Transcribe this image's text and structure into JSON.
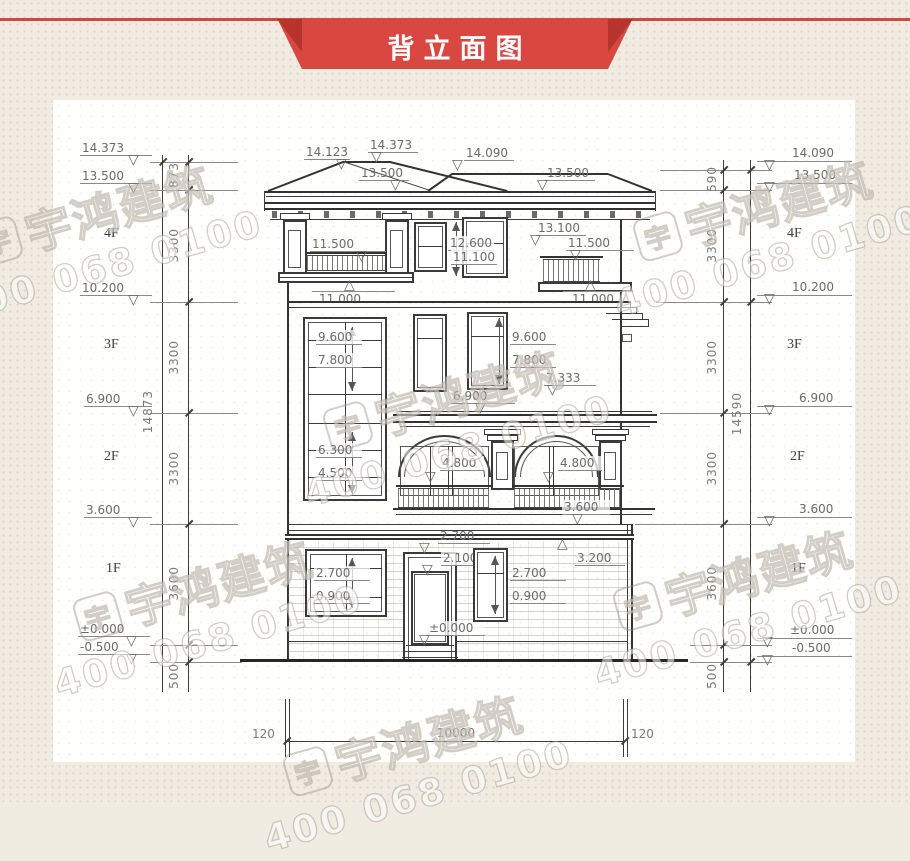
{
  "banner": {
    "title": "背立面图"
  },
  "watermark": {
    "brand": "宇鸿建筑",
    "phone": "400 068 0100",
    "logo_char": "宇"
  },
  "floors": {
    "f4": "4F",
    "f3": "3F",
    "f2": "2F",
    "f1": "1F"
  },
  "levels_left": {
    "l1": "14.373",
    "l2": "13.500",
    "l3": "10.200",
    "l4": "6.900",
    "l5": "3.600",
    "l6": "±0.000",
    "l7": "-0.500"
  },
  "levels_right": {
    "l1": "14.090",
    "l2": "13.500",
    "l3": "10.200",
    "l4": "6.900",
    "l5": "3.600",
    "l6": "±0.000",
    "l7": "-0.500"
  },
  "dims_left": {
    "d1": "873",
    "d2": "3300",
    "d3": "3300",
    "d4": "3300",
    "d5": "3600",
    "d6": "500",
    "total": "14873"
  },
  "dims_right": {
    "d1": "590",
    "d2": "3300",
    "d3": "3300",
    "d4": "3300",
    "d5": "3600",
    "d6": "500",
    "total": "14590"
  },
  "roof_marks": {
    "m1": "14.123",
    "m2": "14.373",
    "m3": "14.090",
    "m4": "13.500",
    "m5": "13.500",
    "m6": "13.100"
  },
  "f4_marks": {
    "m1": "11.500",
    "m2": "12.600",
    "m3": "11.100",
    "m4": "11.500",
    "m5": "11.000",
    "m6": "11.000"
  },
  "f3_marks": {
    "m1": "9.600",
    "m2": "7.800",
    "m3": "9.600",
    "m4": "7.800",
    "m5": "7.333",
    "m6": "6.900"
  },
  "f2_marks": {
    "m1": "6.300",
    "m2": "4.500",
    "m3": "4.800",
    "m4": "4.800",
    "m5": "3.600",
    "m6": "3.200"
  },
  "f1_marks": {
    "m1": "2.700",
    "m2": "0.900",
    "m3": "2.700",
    "m4": "2.100",
    "m5": "±0.000",
    "m6": "2.700",
    "m7": "0.900",
    "m8": "3.200"
  },
  "bottom_dims": {
    "d1": "120",
    "d2": "10000",
    "d3": "120"
  }
}
